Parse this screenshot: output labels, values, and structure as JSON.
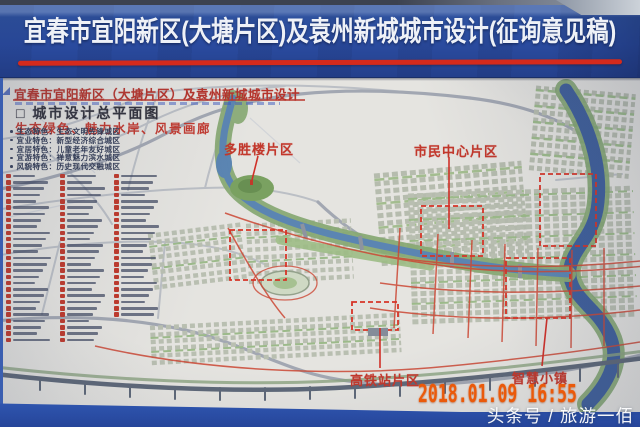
{
  "banner": {
    "title": "宜春市宜阳新区(大塘片区)及袁州新城城市设计(征询意见稿)"
  },
  "poster": {
    "subtitle": "宜春市宜阳新区（大塘片区）及袁州新城城市设计",
    "section_heading": "□ 城市设计总平面图",
    "slogan": "生态绿色、魅力水岸、风景画廊",
    "features": [
      "生态特色：生态文明先锋城区",
      "宜业特色：新型经济综合城区",
      "宜居特色：儿童老年友好城区",
      "宜游特色：禅意魅力滨水城区",
      "风貌特色：历史现代交融城区"
    ],
    "legend": {
      "columns": 3,
      "entries_illegible": true
    },
    "map_labels": {
      "duoshenglou": "多胜楼片区",
      "shimin_zhongxin": "市民中心片区",
      "gaotiezhan": "高铁站片区",
      "zhihui_xiaozhen": "智慧小镇"
    }
  },
  "photo": {
    "timestamp": "2018.01.09 16:55",
    "watermark": "头条号 / 旅游一佰"
  },
  "colors": {
    "board_blue": "#2a4b9f",
    "banner_underline_red": "#d52a1c",
    "map_label_red": "#c2372b",
    "timestamp_orange": "#ea5a0b"
  }
}
